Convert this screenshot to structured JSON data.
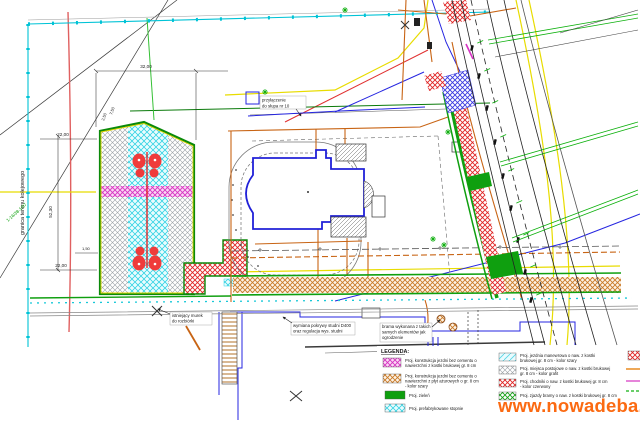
{
  "labels": {
    "boundary": "granica terenu kolejowego",
    "parcel": "1-16/38-1/07"
  },
  "callouts": {
    "pole": [
      "przyłączenie",
      "do słupa nr 10"
    ],
    "wall": [
      "istniejący murek",
      "do rozbiórki"
    ],
    "well": [
      "wymiana pokrywy studni D400",
      "oraz regulacja wys. studni"
    ],
    "gate": [
      "brama wykonana z takich",
      "samych elementów jak",
      "ogrodzenie"
    ]
  },
  "dims": {
    "w32": "32,00",
    "h22a": "22,00",
    "h22b": "22,00",
    "v5230": "52,30",
    "s150a": "1,50",
    "s150b": "1,50",
    "s150c": "1,50",
    "o250": "2,50",
    "o750": "7,50",
    "l500": "5,00"
  },
  "legend": {
    "title": "LEGENDA:",
    "col1": [
      {
        "l1": "Proj. konstrukcja jezdni bez cementu o",
        "l2": "nawierzchni z kostki brukowej gr. 8 cm",
        "l3": ""
      },
      {
        "l1": "Proj. konstrukcja jezdni bez cementu o",
        "l2": "nawierzchni z płyt ażurowych o gr. 8 cm",
        "l3": "- kolor szary"
      },
      {
        "l1": "Proj. zieleń",
        "l2": "",
        "l3": ""
      },
      {
        "l1": "Proj. prefabrykowane stopnie",
        "l2": "",
        "l3": ""
      }
    ],
    "col2": [
      {
        "l1": "Proj. jezdnia manewrowa o naw. z kostki",
        "l2": "brukowej gr. 8 cm - kolor szary"
      },
      {
        "l1": "Proj. miejsca postojowe o naw. z kostki brukowej",
        "l2": "gr. 8 cm - kolor grafit"
      },
      {
        "l1": "Proj. chodniki o naw. z kostki brukowej gr. 8 cm",
        "l2": "- kolor czerwony"
      },
      {
        "l1": "Proj. zjazdy bramy o naw. z kostki brukowej gr. 8 cm",
        "l2": ""
      }
    ],
    "col3": [
      {
        "swatch": "red-diagonal-hatch"
      },
      {
        "swatch": "orange-line"
      },
      {
        "swatch": "magenta-line"
      },
      {
        "swatch": "green-line"
      }
    ]
  },
  "watermark": {
    "text": "www.nowadeba.pl",
    "color": "#fb6a12"
  },
  "colors": {
    "boundary_cyan": "#00c3d6",
    "parking_border_green": "#0a8a0a",
    "lane_cyan": "#2fd2e2",
    "stall_gray": "#9aa0a6",
    "crossing_magenta": "#d633c2",
    "feature_red": "#ef3b3b",
    "utility_orange": "#c86414",
    "utility_yellow": "#e8dc00",
    "utility_blue": "#2525e0",
    "building_blue": "#2020d8",
    "greenery": "#0f9f0f",
    "sidewalk_red": "#e02424",
    "driveway_orange": "#c97a28",
    "watermark_orange": "#fb6a12"
  }
}
